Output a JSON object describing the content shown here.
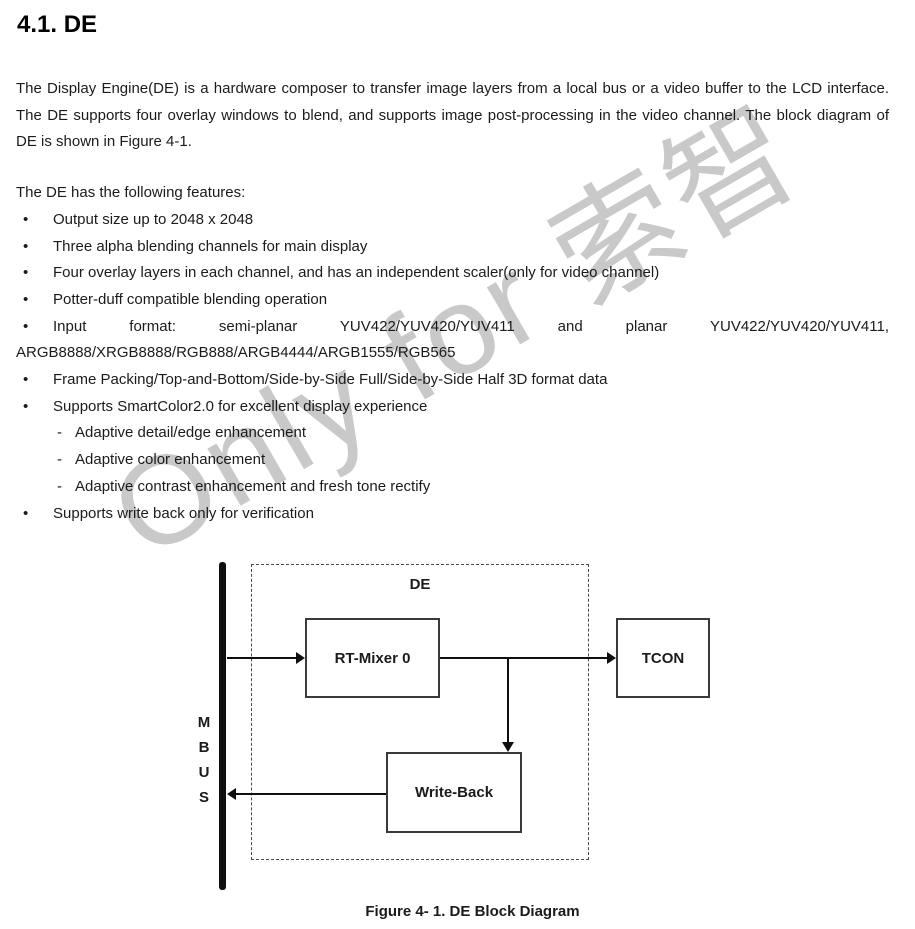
{
  "document": {
    "heading": "4.1. DE",
    "watermark_text": "Only for 索智",
    "intro_paragraph": "The Display Engine(DE) is a hardware composer to transfer image layers from a local bus or a video buffer to the LCD interface. The DE supports four overlay windows to blend, and supports image post-processing in the video channel. The block diagram of DE is shown in Figure 4-1.",
    "features_intro": "The DE has the following features:",
    "bullet_char": "•",
    "dash_char": "-",
    "features": [
      {
        "text": "Output size up to 2048 x 2048"
      },
      {
        "text": "Three alpha blending channels for main display"
      },
      {
        "text": "Four overlay layers in each channel, and has an independent scaler(only for video channel)"
      },
      {
        "text": "Potter-duff compatible blending operation"
      },
      {
        "text": "Input format: semi-planar YUV422/YUV420/YUV411 and planar YUV422/YUV420/YUV411, ARGB8888/XRGB8888/RGB888/ARGB4444/ARGB1555/RGB565"
      },
      {
        "text": "Frame Packing/Top-and-Bottom/Side-by-Side Full/Side-by-Side Half 3D format data"
      },
      {
        "text": "Supports SmartColor2.0 for excellent display experience",
        "subitems": [
          "Adaptive detail/edge enhancement",
          "Adaptive color enhancement",
          "Adaptive contrast enhancement and fresh tone rectify"
        ]
      },
      {
        "text": "Supports write back only for verification"
      }
    ],
    "diagram": {
      "container_label": "DE",
      "bus_label": "M\nB\nU\nS",
      "blocks": {
        "rt_mixer": "RT-Mixer 0",
        "tcon": "TCON",
        "write_back": "Write-Back"
      },
      "caption": "Figure 4- 1. DE Block Diagram"
    },
    "colors": {
      "text": "#1b1b1b",
      "watermark": "#c9c9c9",
      "line": "#0f0f0f",
      "box_border": "#3a3a3a"
    }
  }
}
